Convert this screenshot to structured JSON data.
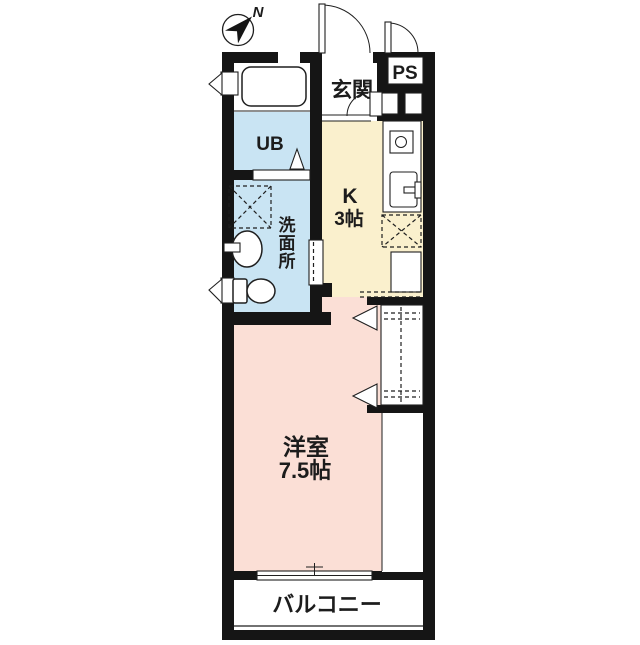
{
  "plan": {
    "compass_north": "N",
    "entrance_label": "玄関",
    "pipe_space_label": "PS",
    "unit_bath_label": "UB",
    "washroom_label": "洗面所",
    "washroom_chars": [
      "洗",
      "面",
      "所"
    ],
    "kitchen_label": "K",
    "kitchen_size": "3帖",
    "room_label": "洋室",
    "room_size": "7.5帖",
    "balcony_label": "バルコニー"
  },
  "colors": {
    "wall": "#151515",
    "line": "#1f1f1f",
    "wet_area": "#c9e4f3",
    "kitchen_area": "#faf0cd",
    "room_area": "#fbdfd6",
    "text": "#1c1c1c",
    "background": "#ffffff"
  }
}
